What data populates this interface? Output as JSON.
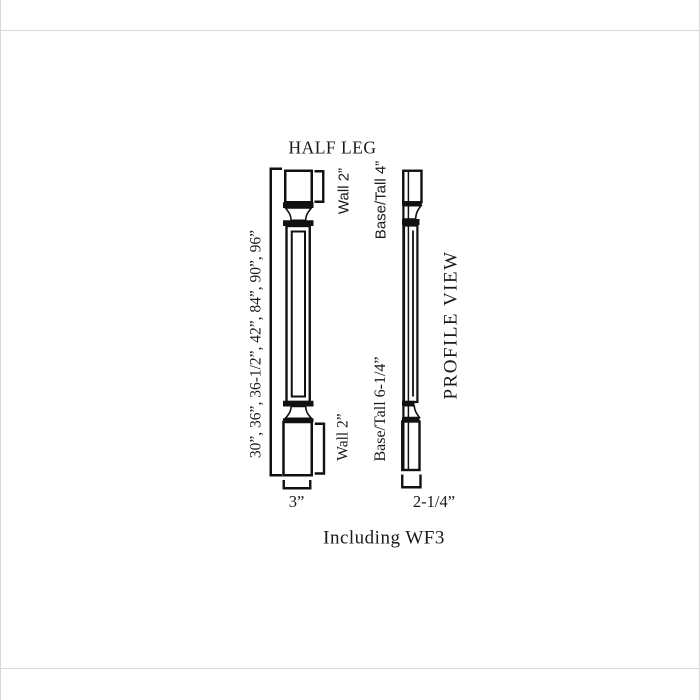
{
  "canvas": {
    "background": "#ffffff",
    "frame_color": "#d9d9d9",
    "line_color": "#111111",
    "text_color": "#1a1a1a"
  },
  "diagram": {
    "title": "HALF LEG",
    "footer_note": "Including WF3",
    "front_view": {
      "available_heights": "30”, 36”, 36-1/2”, 42”, 84”, 90”, 96”",
      "top_section_wall": "Wall 2”",
      "top_section_base_tall": "Base/Tall 4”",
      "bottom_section_wall": "Wall 2”",
      "bottom_section_base_tall": "Base/Tall 6-1/4”",
      "width": "3”"
    },
    "profile_view": {
      "label": "PROFILE VIEW",
      "depth": "2-1/4”"
    }
  }
}
